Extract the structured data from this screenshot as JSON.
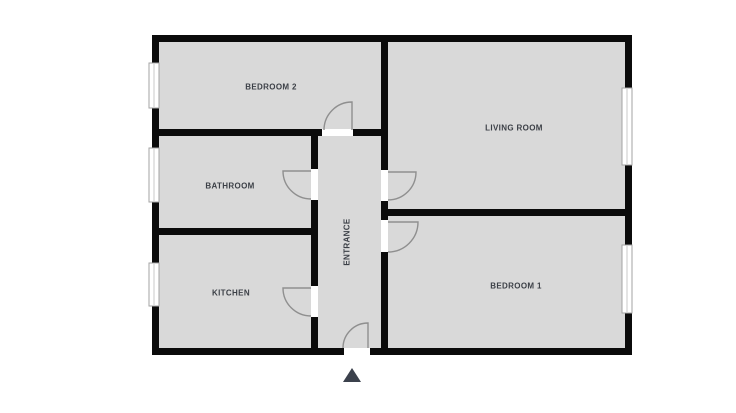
{
  "title": "apartment-floor-plan",
  "rooms": [
    {
      "id": "bedroom-2",
      "label": "BEDROOM 2"
    },
    {
      "id": "living-room",
      "label": "LIVING ROOM"
    },
    {
      "id": "bathroom",
      "label": "BATHROOM"
    },
    {
      "id": "kitchen",
      "label": "KITCHEN"
    },
    {
      "id": "bedroom-1",
      "label": "BEDROOM 1"
    },
    {
      "id": "entrance",
      "label": "ENTRANCE"
    }
  ],
  "markers": {
    "entrance_arrow": "triangle-up"
  },
  "colors": {
    "background": "#ffffff",
    "room_fill": "#d9d9d9",
    "wall": "#0b0b0b",
    "door_arc": "#8f8f8f",
    "window_frame": "#a3a3a3",
    "label_text": "#3b3f46",
    "entrance_marker": "#3b414c"
  }
}
